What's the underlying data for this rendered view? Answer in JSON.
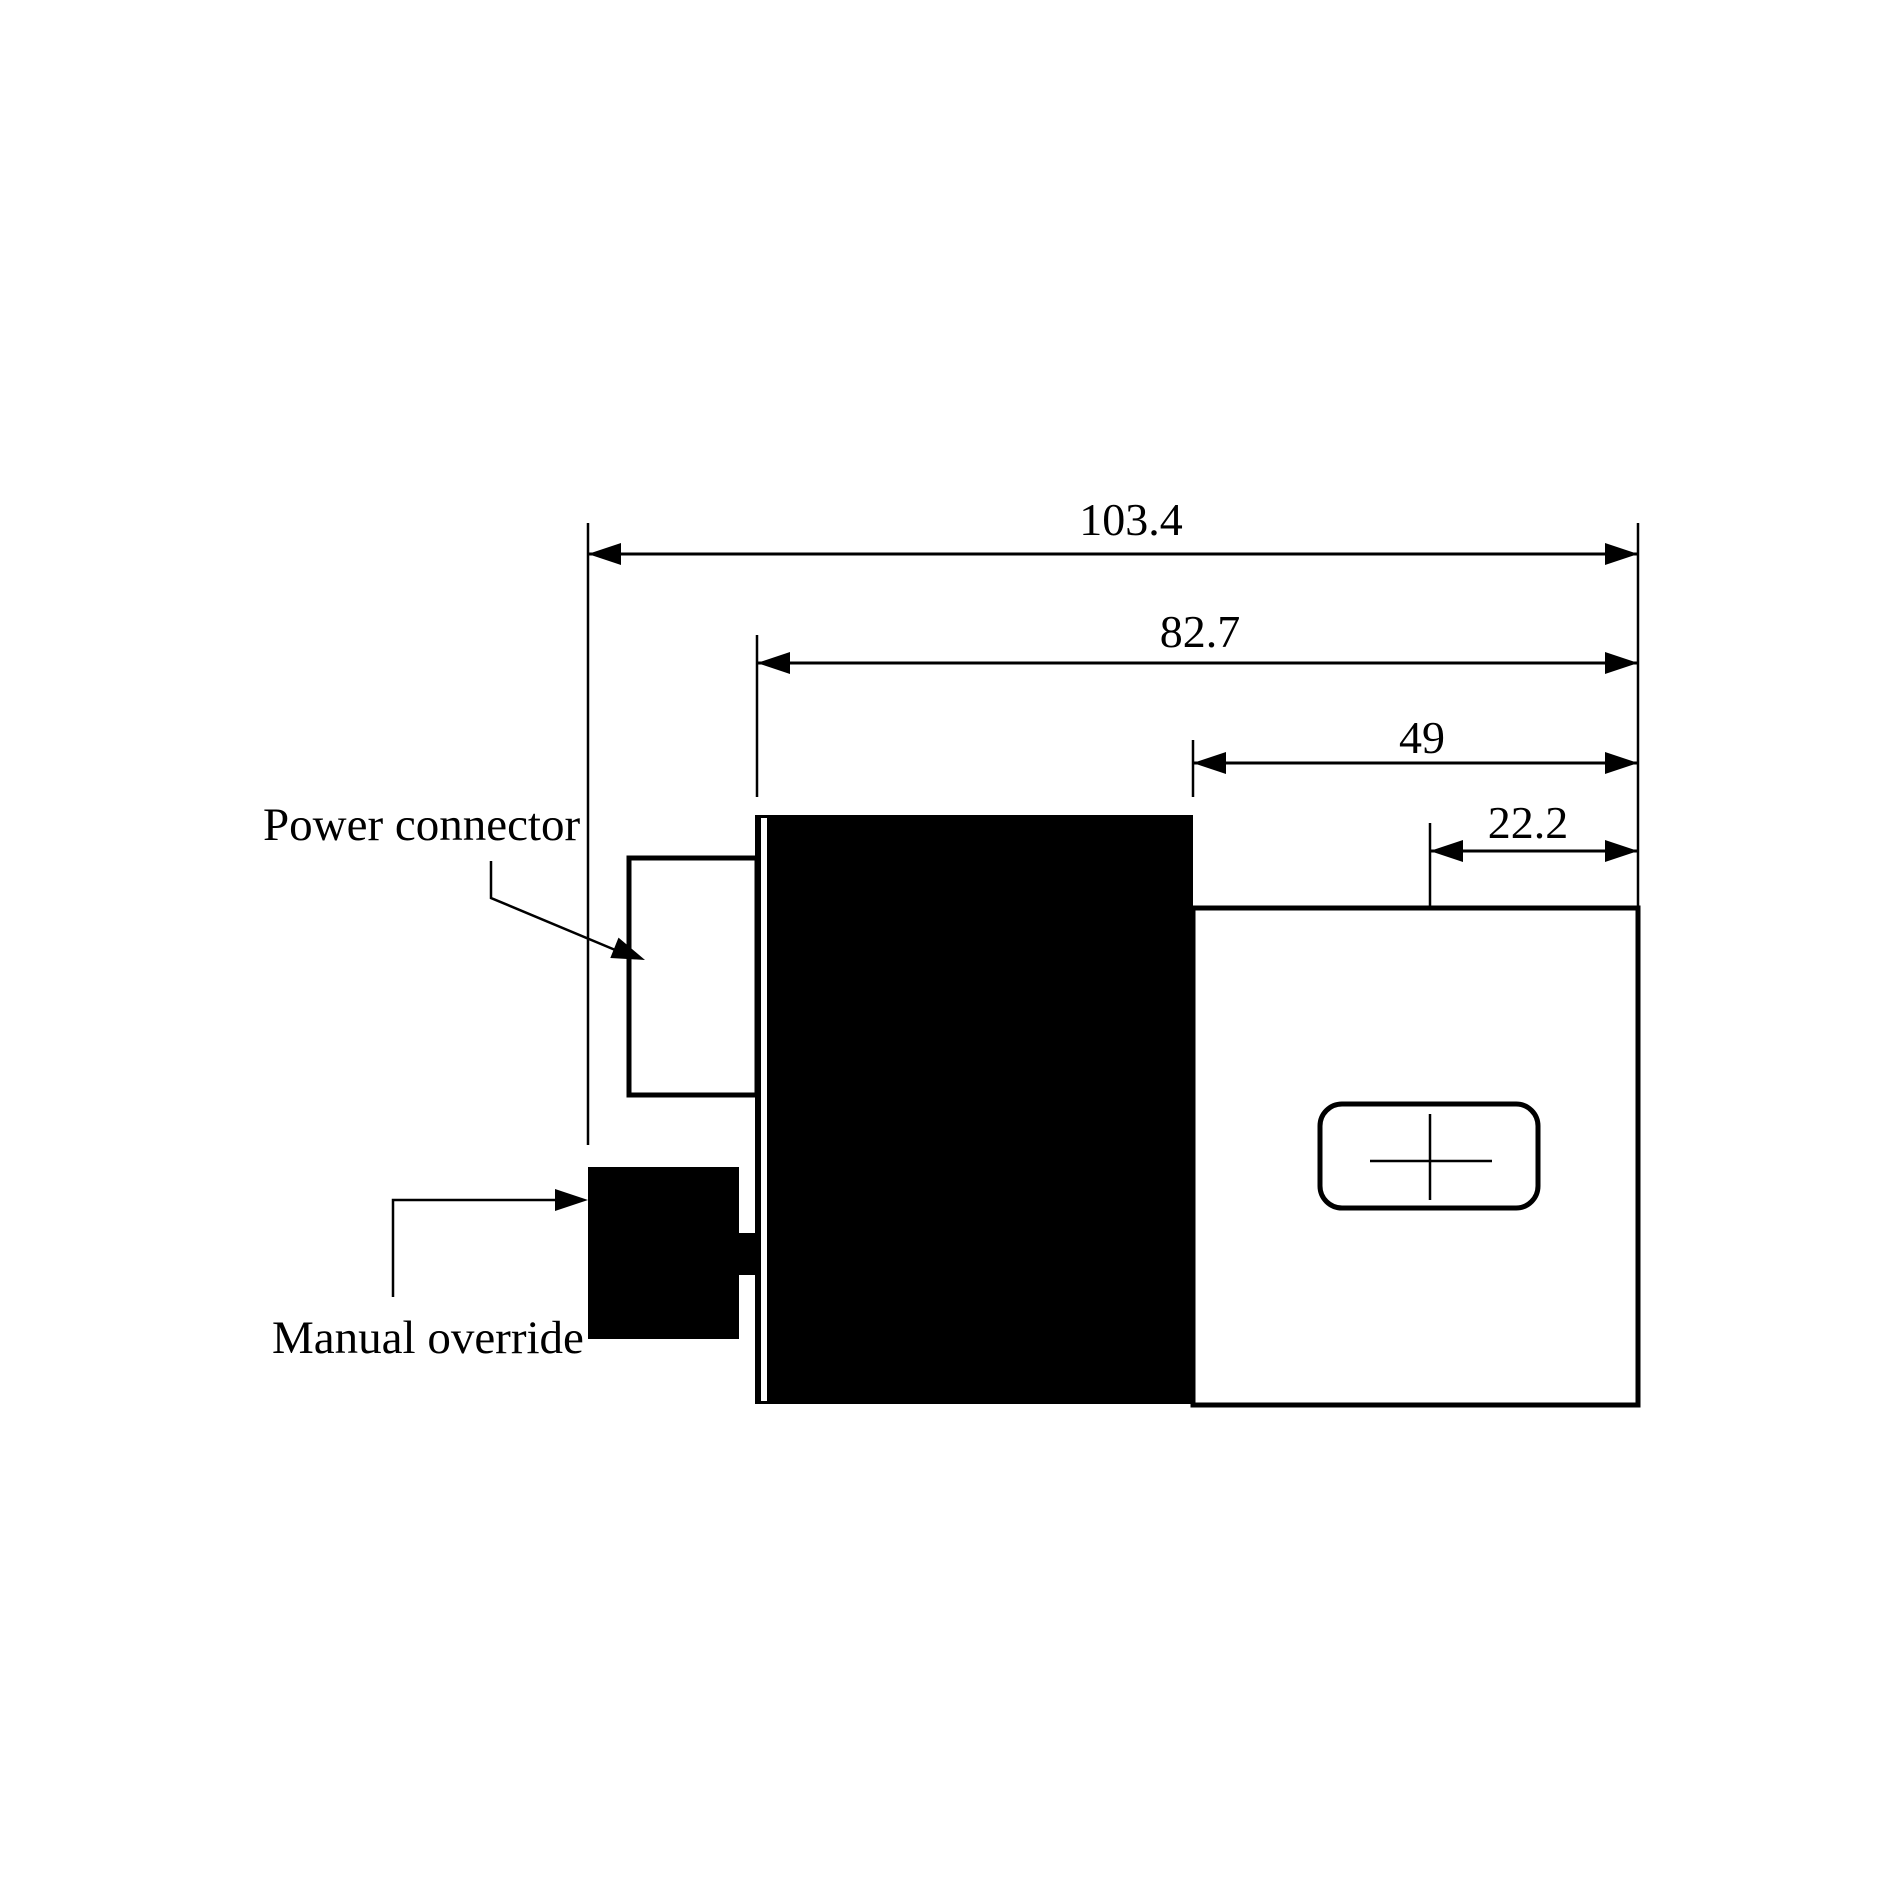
{
  "drawing": {
    "dimensions": [
      {
        "name": "overall-length",
        "label": "103.4"
      },
      {
        "name": "coil-assembly-length",
        "label": "82.7"
      },
      {
        "name": "valve-body-length",
        "label": "49"
      },
      {
        "name": "port-center-offset",
        "label": "22.2"
      }
    ],
    "callouts": [
      {
        "name": "power-connector",
        "label": "Power connector"
      },
      {
        "name": "manual-override",
        "label": "Manual override"
      }
    ],
    "colors": {
      "ink": "#000000",
      "paper": "#ffffff"
    }
  }
}
